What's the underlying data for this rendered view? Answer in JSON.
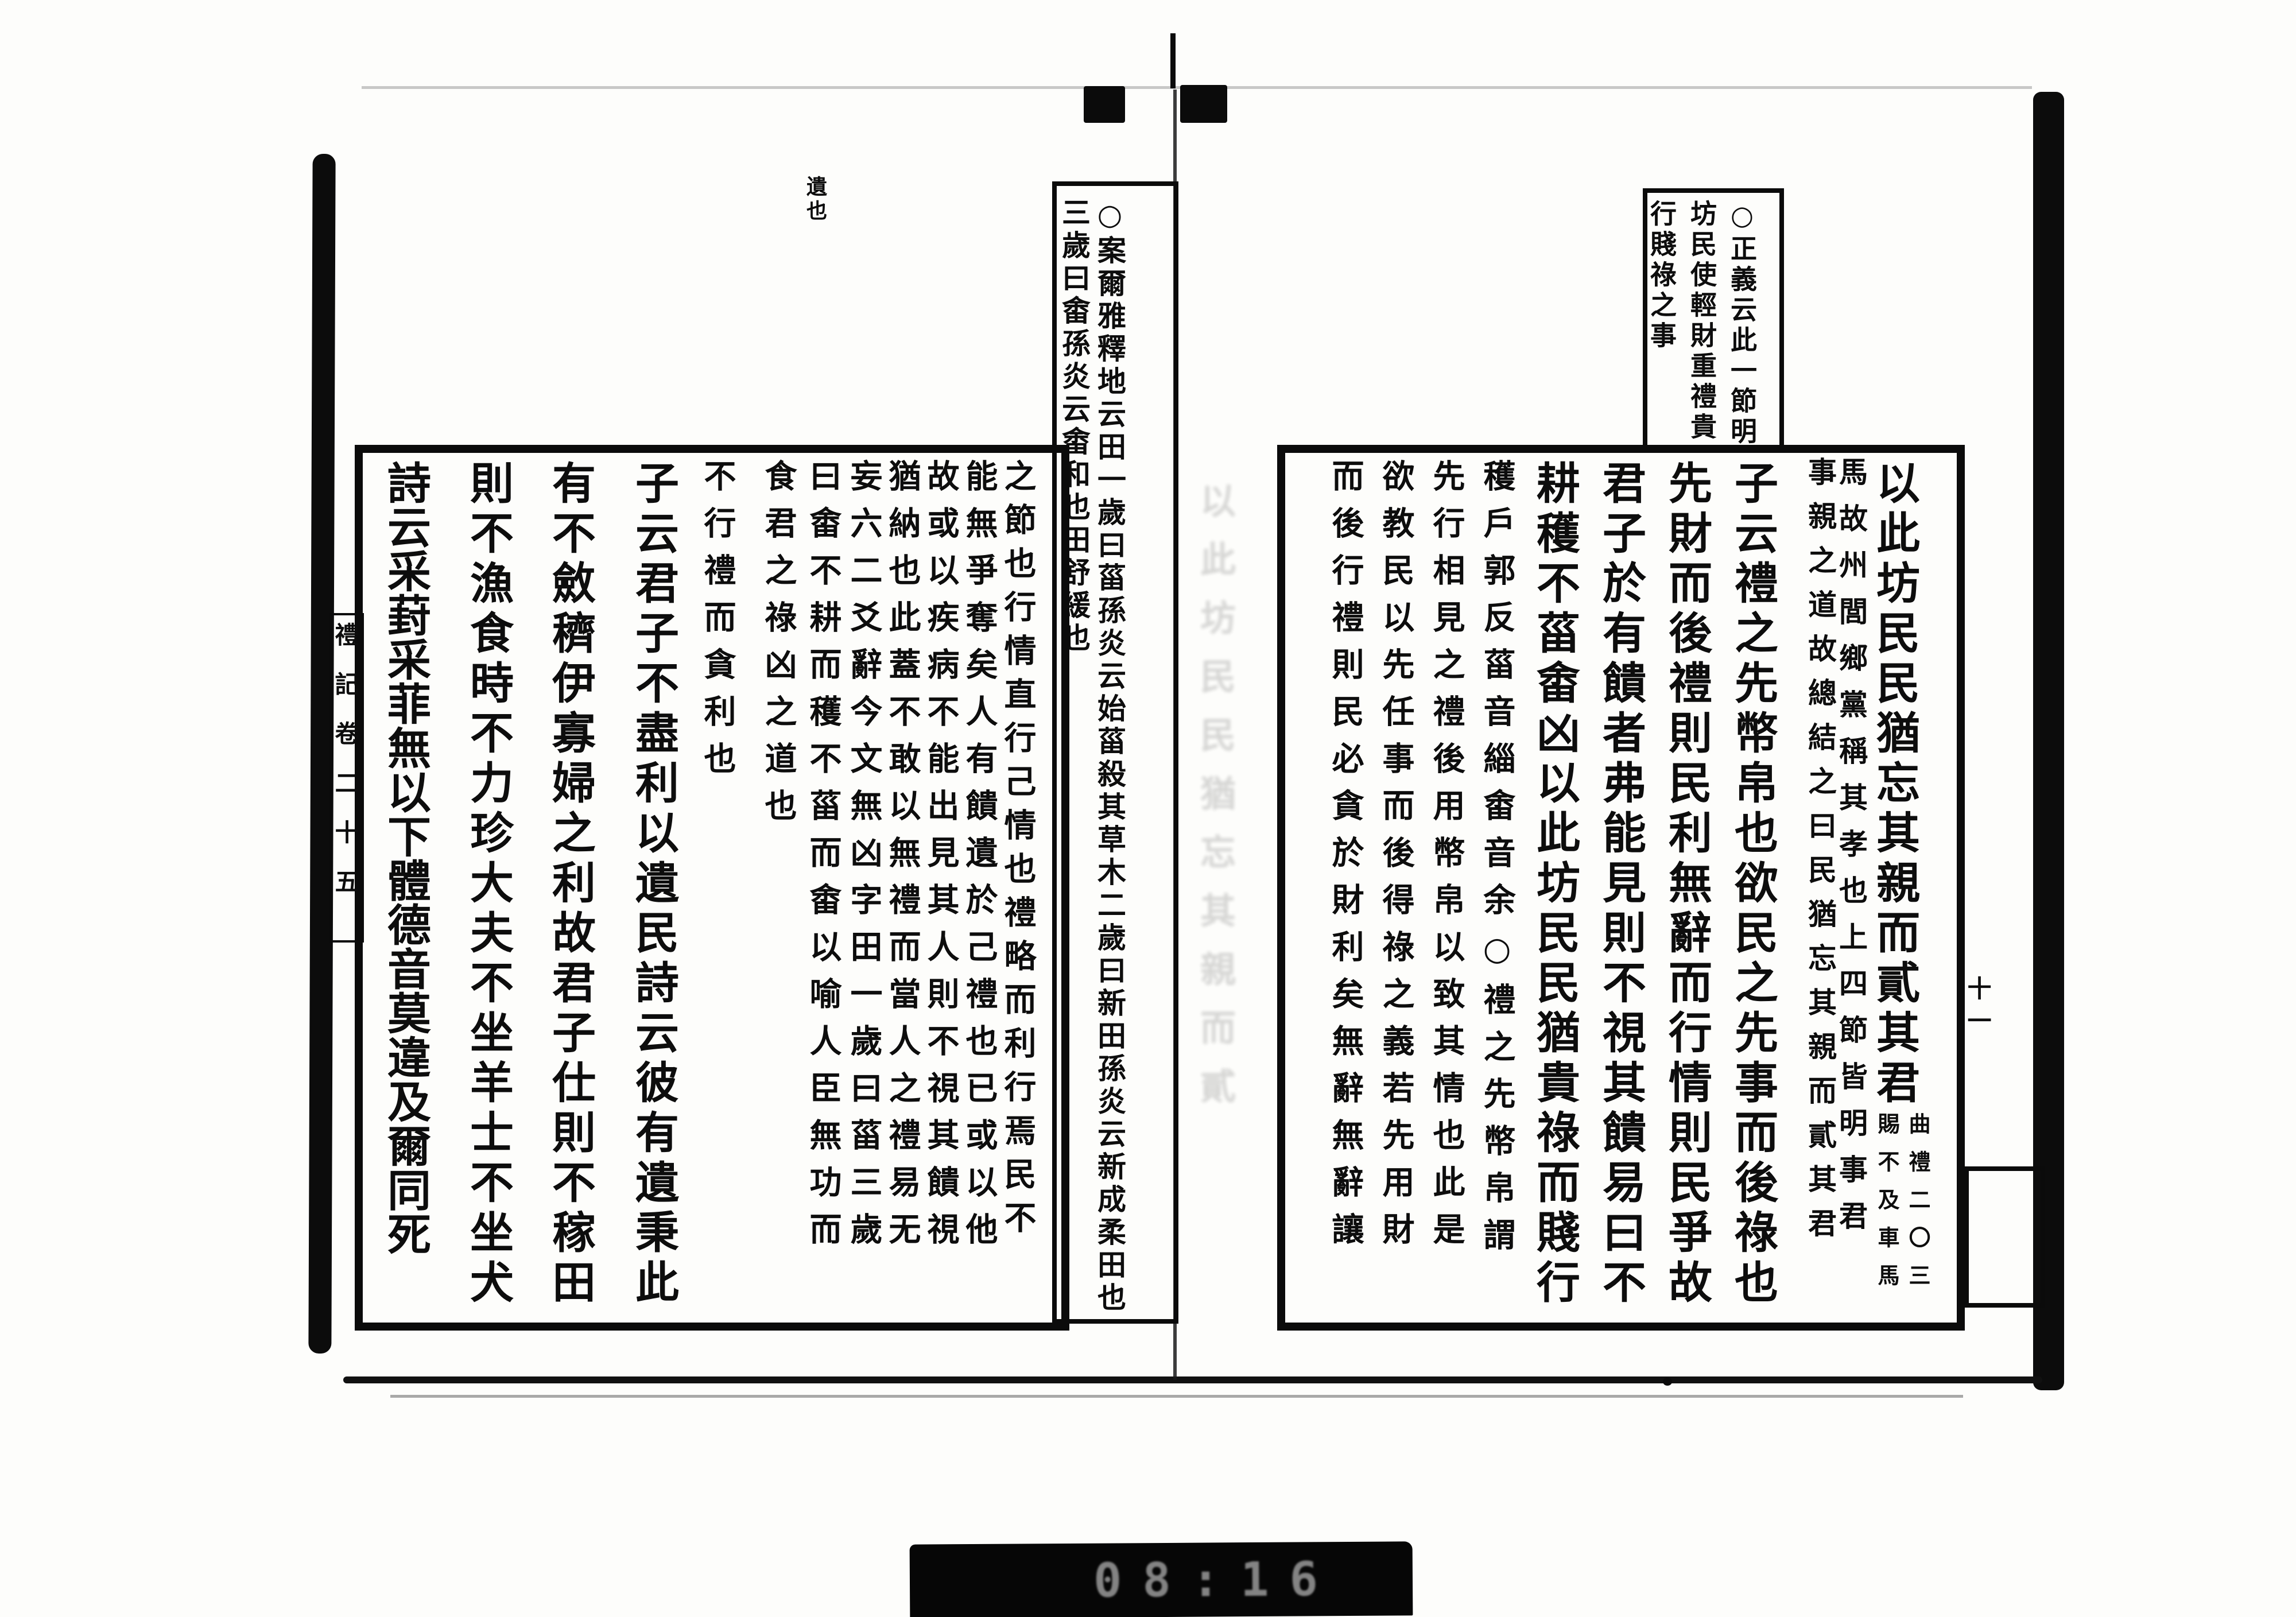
{
  "scan": {
    "film_counter": "08:16",
    "leaf_number": "十一",
    "margin_title": "禮記卷二十五",
    "margin_note": "遺也",
    "gutter_ghost": "以此坊民民猶忘其親而貳"
  },
  "right_page": {
    "head_note": {
      "col1": "○正義云此一節明",
      "col2": "坊民使輕財重禮貴",
      "col3": "行賤祿之事"
    },
    "columns": {
      "c1_main": "以此坊民民猶忘其親而貳其君",
      "c1_note_right": "曲禮二〇三",
      "c1_note_left": "賜不及車馬",
      "c2_right_half": "馬故州閭鄉黨稱其孝也上四節皆明事君",
      "c2_left_half": "事親之道故總結之曰民猶忘其親而貳其君",
      "c3": "子云禮之先幣帛也欲民之先事而後祿也",
      "c4": "先財而後禮則民利無辭而行情則民爭故",
      "c5": "君子於有饋者弗能見則不視其饋易曰不",
      "c6": "耕穫不菑畬凶以此坊民民猶貴祿而賤行",
      "c7": "穫戶郭反菑音緇畬音余○禮之先幣帛謂",
      "c8": "先行相見之禮後用幣帛以致其情也此是",
      "c9": "欲教民以先任事而後得祿之義若先用財",
      "c10": "而後行禮則民必貪於財利矣無辭無辭讓"
    }
  },
  "left_page": {
    "spine_note": {
      "col_a": "○案爾雅釋地云田一歲曰菑孫炎云始菑殺其草木二歲曰新田孫炎云新成柔田也",
      "col_b": "三歲曰畬孫炎云畬和也田舒緩也"
    },
    "columns": {
      "c1": "之節也行情直行己情也禮略而利行焉民不",
      "c2": "能無爭奪矣人有饋遺於己禮也已或以他",
      "c3": "故或以疾病不能出見其人則不視其饋視",
      "c4": "猶納也此蓋不敢以無禮而當人之禮易无",
      "c5": "妄六二爻辭今文無凶字田一歲曰菑三歲",
      "c6": "曰畬不耕而穫不菑而畬以喻人臣無功而",
      "c7": "食君之祿凶之道也",
      "c8": "不行禮而貪利也",
      "c9": "子云君子不盡利以遺民詩云彼有遺秉此",
      "c10": "有不斂穧伊寡婦之利故君子仕則不稼田",
      "c11": "則不漁食時不力珍大夫不坐羊士不坐犬",
      "c12": "詩云采葑采菲無以下體德音莫違及爾同死"
    }
  }
}
